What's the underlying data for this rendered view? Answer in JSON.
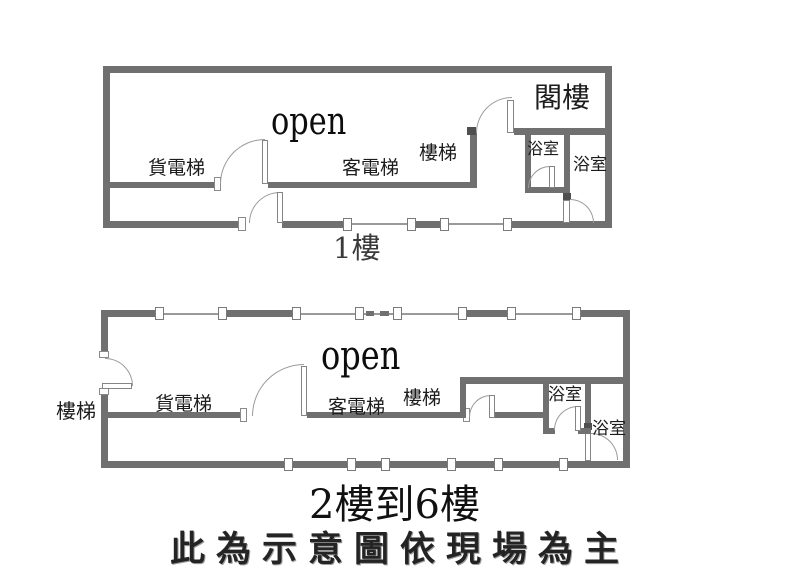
{
  "colors": {
    "wall": "#707070",
    "thin_wall": "#9a9a9a",
    "door_arc": "#9b9b9b",
    "text": "#1c1c1c",
    "background": "#ffffff"
  },
  "plan1": {
    "caption": "1樓",
    "labels": {
      "freight_elevator": "貨電梯",
      "open_area": "open",
      "passenger_elevator": "客電梯",
      "stairs": "樓梯",
      "attic": "閣樓",
      "bathroom_left": "浴室",
      "bathroom_right": "浴室"
    }
  },
  "plan2": {
    "caption": "2樓到6樓",
    "labels": {
      "stairs_outside": "樓梯",
      "freight_elevator": "貨電梯",
      "open_area": "open",
      "passenger_elevator": "客電梯",
      "stairs": "樓梯",
      "bathroom_upper": "浴室",
      "bathroom_lower": "浴室"
    }
  },
  "footer": {
    "disclaimer": "此為示意圖依現場為主"
  }
}
